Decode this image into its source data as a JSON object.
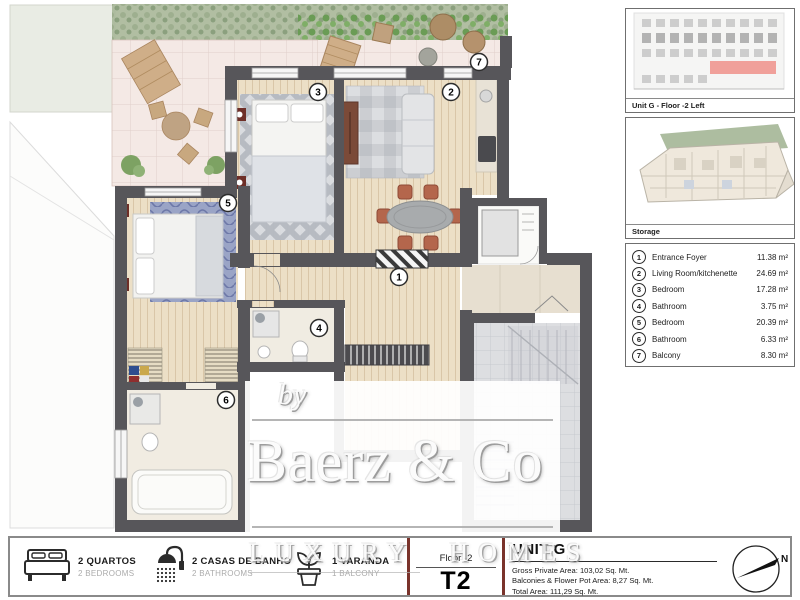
{
  "plan": {
    "markers": {
      "m1": "1",
      "m2": "2",
      "m3": "3",
      "m4": "4",
      "m5": "5",
      "m6": "6",
      "m7": "7"
    },
    "watermark": {
      "prefix": "by",
      "brand": "Baerz & Co",
      "tagline": "LUXURY HOMES"
    }
  },
  "side_panel": {
    "unit_caption": "Unit G - Floor -2 Left",
    "storage_caption": "Storage",
    "legend": [
      {
        "num": "1",
        "name": "Entrance Foyer",
        "area": "11.38 m²"
      },
      {
        "num": "2",
        "name": "Living Room/kitchenette",
        "area": "24.69 m²"
      },
      {
        "num": "3",
        "name": "Bedroom",
        "area": "17.28 m²"
      },
      {
        "num": "4",
        "name": "Bathroom",
        "area": "3.75 m²"
      },
      {
        "num": "5",
        "name": "Bedroom",
        "area": "20.39 m²"
      },
      {
        "num": "6",
        "name": "Bathroom",
        "area": "6.33 m²"
      },
      {
        "num": "7",
        "name": "Balcony",
        "area": "8.30 m²"
      }
    ]
  },
  "footer": {
    "features": [
      {
        "icon": "bed-icon",
        "pt": "2 QUARTOS",
        "en": "2 BEDROOMS"
      },
      {
        "icon": "shower-icon",
        "pt": "2 CASAS DE BANHO",
        "en": "2 BATHROOMS"
      },
      {
        "icon": "plant-icon",
        "pt": "1 VARANDA",
        "en": "1 BALCONY"
      }
    ],
    "floor_label": "Floor -2",
    "type_label": "T2",
    "unit_title": "UNIT G",
    "areas": [
      "Gross Private Area: 103,02 Sq. Mt.",
      "Balconies & Flower Pot Area: 8,27 Sq. Mt.",
      "Total Area: 111,29 Sq. Mt."
    ],
    "compass_label": "N"
  },
  "colors": {
    "wall": "#57565a",
    "wood_floor": "#ecdfc6",
    "terrace_tile": "#f4e9e5",
    "hedge_green": "#a8b798",
    "accent_maroon": "#7a332b",
    "unit_highlight_red": "#f0a09a",
    "rug_blue": "#9aa4c6",
    "chair_terracotta": "#b4664c"
  }
}
